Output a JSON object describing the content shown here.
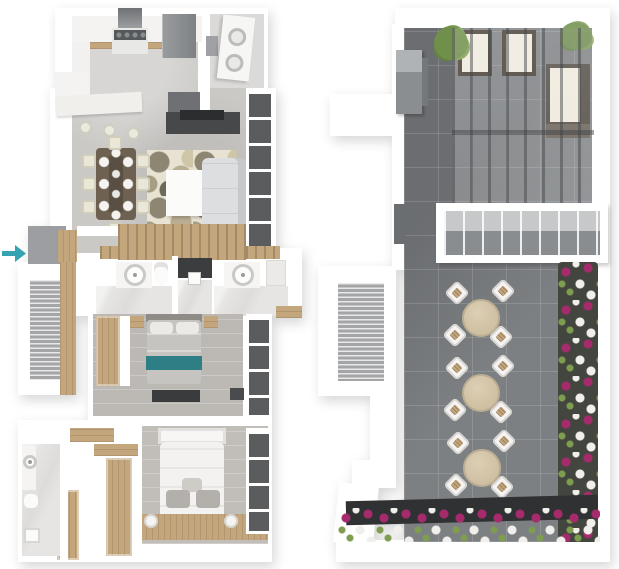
{
  "image": {
    "description": "Two 3D rendered top-down floor plans side by side: a furnished apartment level (left) and a roof terrace (right)",
    "width": 619,
    "height": 569,
    "background": "#ffffff"
  },
  "colors": {
    "accent_arrow": "#35a3b2",
    "wall": "#ffffff",
    "floor_concrete": "#cac9c6",
    "floor_marble": "#e6e5e3",
    "floor_wood_gray": "#bcb9b5",
    "wood": "#c4a67c",
    "wood_dark": "#a98c60",
    "tile": "#7d8083",
    "glass": "#5a5c5e",
    "appliance": "#8b8e91",
    "sofa": "#dcdedf",
    "teal_bench": "#2e7e86",
    "flower_magenta": "#a62b6c",
    "flower_white": "#f1efec",
    "foliage": "#7e9d4f",
    "planter": "#43453f",
    "planter_bar": "#2f3133",
    "cream": "#efeadd",
    "frame_dark": "#4b4238"
  },
  "plans": {
    "apartment": {
      "name": "apartment-floor-plan",
      "entry_arrow": {
        "direction": "right",
        "color": "#35a3b2"
      },
      "rooms": [
        {
          "label": "kitchen",
          "items": [
            "range",
            "range-hood",
            "refrigerator",
            "counters",
            "breakfast-bar",
            "bar-stools x3"
          ]
        },
        {
          "label": "laundry",
          "items": [
            "stacked-washer-dryer",
            "shelf"
          ]
        },
        {
          "label": "dining",
          "items": [
            "dining-table",
            "chairs x8",
            "place-settings x8"
          ]
        },
        {
          "label": "living",
          "items": [
            "sofa",
            "coffee-table",
            "patterned-rug",
            "tv-console",
            "window-wall"
          ]
        },
        {
          "label": "hall-bath",
          "items": [
            "vanity-sink x2",
            "toilet",
            "walk-in-shower",
            "wood-slat-wall"
          ]
        },
        {
          "label": "bedroom-1",
          "items": [
            "double-bed",
            "teal-bed-runner",
            "nightstands x2",
            "media-console",
            "wardrobe",
            "window-wall"
          ]
        },
        {
          "label": "bedroom-2",
          "items": [
            "double-bed-white",
            "gray-pillows x2",
            "nightstand-lamps x2",
            "window-wall"
          ]
        },
        {
          "label": "walk-in-closet",
          "items": [
            "wood-wardrobes x4"
          ]
        },
        {
          "label": "ensuite-bath",
          "items": [
            "sink",
            "toilet",
            "shower"
          ]
        },
        {
          "label": "stairwell",
          "items": [
            "stair-treads"
          ]
        }
      ]
    },
    "terrace": {
      "name": "roof-terrace-plan",
      "features": [
        {
          "label": "pergola-lounge",
          "items": [
            "lounge-chairs x2",
            "corner-sofa",
            "slatted-roof",
            "planter-bushes x2"
          ]
        },
        {
          "label": "grill-station",
          "items": [
            "bbq-grill"
          ]
        },
        {
          "label": "glass-railing",
          "items": [
            "framed-glass-balustrade"
          ]
        },
        {
          "label": "outdoor-dining",
          "items": [
            "round-bistro-tables x3",
            "chairs x12"
          ]
        },
        {
          "label": "flower-planters",
          "items": [
            "right-edge-planter",
            "bottom-edge-planter"
          ],
          "flower_colors": [
            "magenta",
            "white",
            "green"
          ]
        },
        {
          "label": "stairwell",
          "items": [
            "stair-treads"
          ]
        }
      ],
      "bistro_table_count": 3,
      "chairs_per_table": 4
    }
  }
}
